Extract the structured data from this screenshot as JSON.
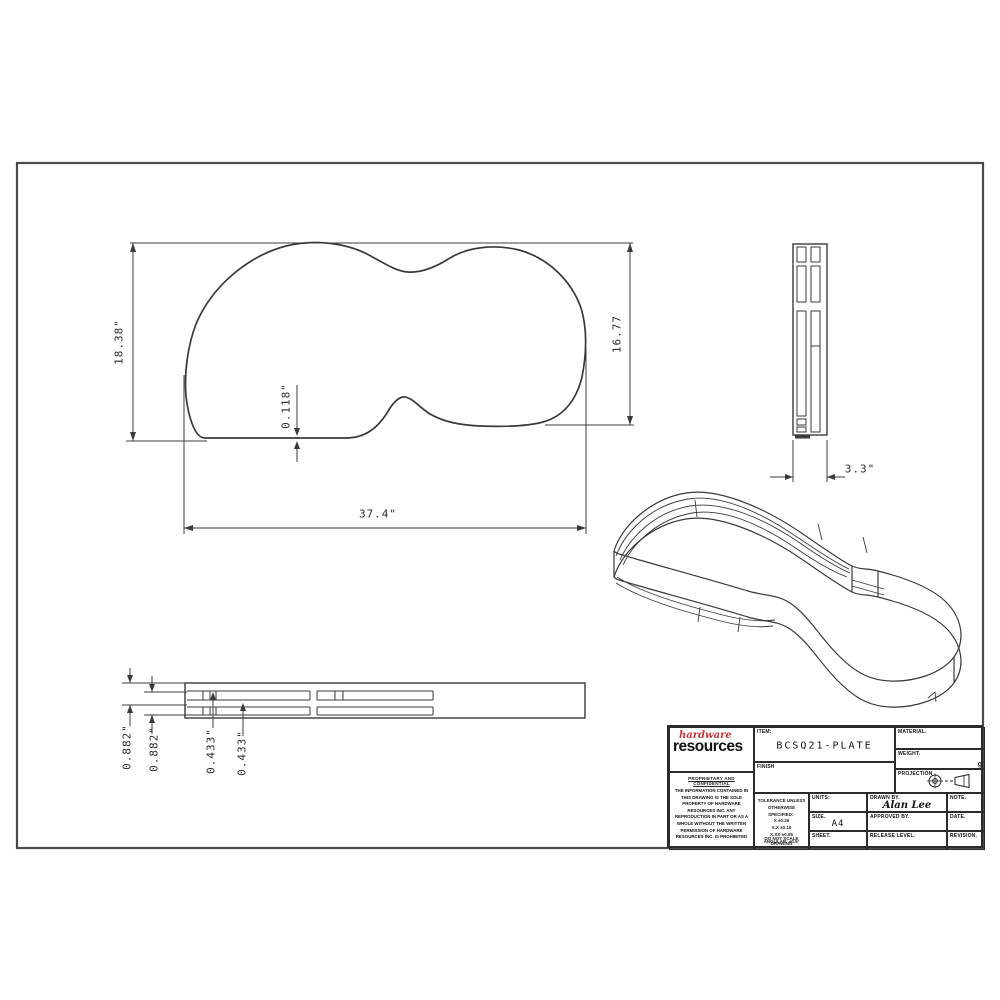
{
  "title_block": {
    "item": {
      "label": "ITEM:",
      "value": "BCSQ21-PLATE"
    },
    "finish": {
      "label": "FINISH"
    },
    "material": {
      "label": "MATERIAL."
    },
    "weight": {
      "label": "WEIGHT.",
      "unit": "g"
    },
    "projection": {
      "label": "PROJECTION"
    },
    "units": {
      "label": "UNITS:"
    },
    "size": {
      "label": "SIZE.",
      "value": "A4"
    },
    "sheet": {
      "label": "SHEET."
    },
    "drawn_by": {
      "label": "DRAWN BY.",
      "value": "Alan Lee"
    },
    "approved_by": {
      "label": "APPROVED BY.",
      "value": ""
    },
    "release_level": {
      "label": "RELEASE LEVEL.",
      "value": ""
    },
    "note": {
      "label": "NOTE.",
      "value": ""
    },
    "date": {
      "label": "DATE.",
      "value": ""
    },
    "revision": {
      "label": "REVISION.",
      "value": ""
    },
    "logo": {
      "line1": "hardware",
      "line2": "resources",
      "accent_color": "#c13a3a"
    },
    "proprietary": {
      "title": "PROPRIETARY AND CONFIDENTIAL",
      "body": "THE INFORMATION CONTAINED IN THIS DRAWING IS THE SOLE PROPERTY OF HARDWARE RESOURCES INC. ANY REPRODUCTION IN PART OR AS A WHOLE WITHOUT THE WRITTEN PERMISSION OF HARDWARE RESOURCES INC. IS PROHIBITED"
    },
    "tolerance": {
      "lines": [
        "TOLERANCE UNLESS",
        "OTHERWISE SPECIFIED:-",
        "X      ±0.25",
        "X.X     ±0.10",
        "X.XX    ±0.05",
        "ANGULAR: ±0.5°"
      ],
      "footer": "DO NOT SCALE DRAWING"
    }
  },
  "dimensions": {
    "front_view": {
      "overall_height": "18.38\"",
      "right_height": "16.77",
      "wall_thickness": "0.118\"",
      "overall_width": "37.4\""
    },
    "side_view": {
      "depth": "3.3\""
    },
    "edge_view": {
      "d1": "0.882\"",
      "d2": "0.882\"",
      "d3": "0.433\"",
      "d4": "0.433\""
    }
  }
}
